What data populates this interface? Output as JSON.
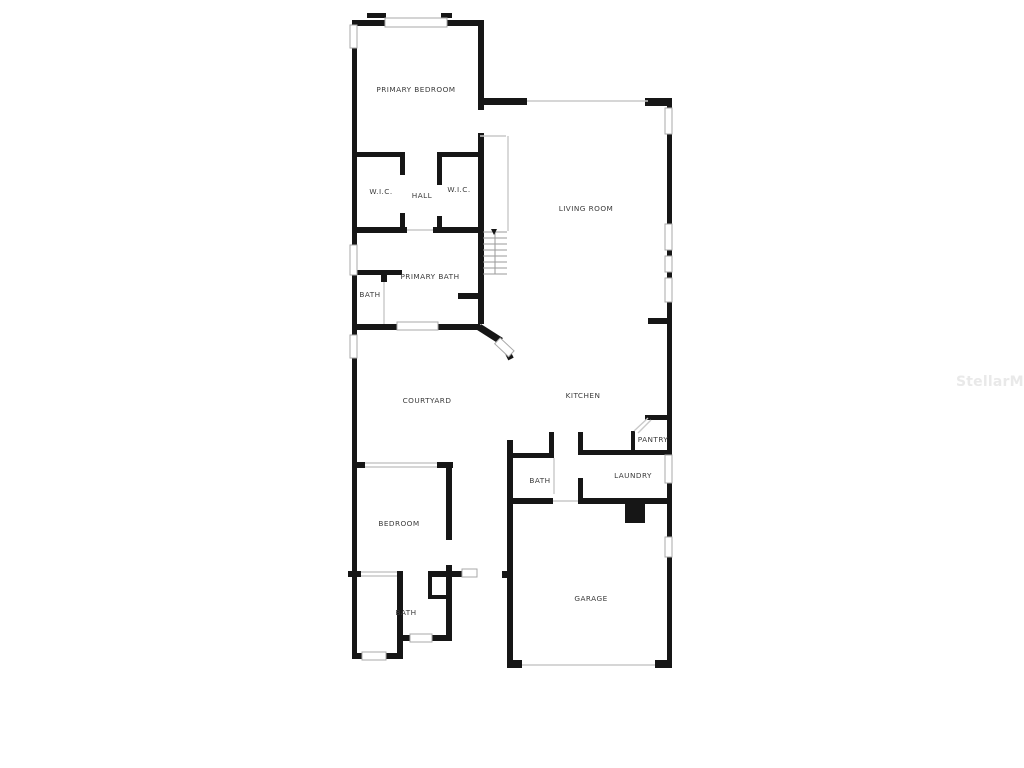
{
  "watermark": "StellarMLS",
  "rooms": {
    "primary_bedroom": "PRIMARY BEDROOM",
    "wic_left": "W.I.C.",
    "hall": "HALL",
    "wic_right": "W.I.C.",
    "living_room": "LIVING ROOM",
    "primary_bath": "PRIMARY BATH",
    "primary_bath_wc": "BATH",
    "courtyard": "COURTYARD",
    "kitchen": "KITCHEN",
    "pantry": "PANTRY",
    "hall_bath": "BATH",
    "laundry": "LAUNDRY",
    "bedroom": "BEDROOM",
    "guest_bath": "BATH",
    "garage": "GARAGE"
  },
  "colors": {
    "wall": "#161616",
    "window_border": "#a9a9a9",
    "opening_line": "#c9c9c9",
    "stair_tread": "#9a9a9a",
    "label": "#3b3b3b",
    "watermark": "#e9e9e9"
  }
}
